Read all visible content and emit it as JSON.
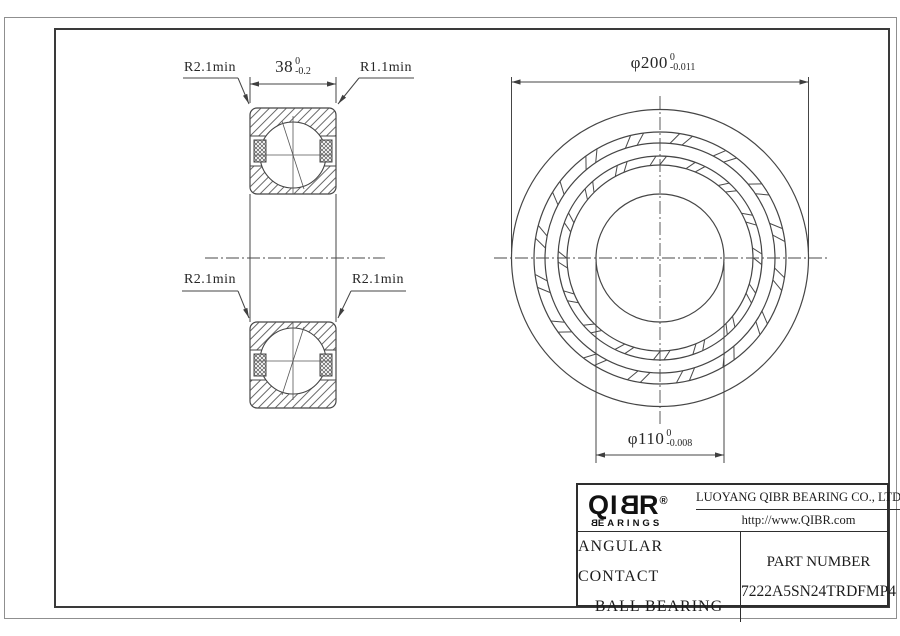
{
  "drawing": {
    "labels": {
      "radius_top_left": "R2.1min",
      "radius_top_right": "R1.1min",
      "radius_mid_left": "R2.1min",
      "radius_mid_right": "R2.1min"
    },
    "dimensions": {
      "width": {
        "value": "38",
        "tol_upper": "0",
        "tol_lower": "-0.2"
      },
      "outer_diameter": {
        "value": "φ200",
        "tol_upper": "0",
        "tol_lower": "-0.011"
      },
      "bore_diameter": {
        "value": "φ110",
        "tol_upper": "0",
        "tol_lower": "-0.008"
      }
    }
  },
  "title_block": {
    "logo": {
      "text_start": "QI",
      "text_b": "B",
      "text_end": "R",
      "reg": "®",
      "sub_start": "B",
      "sub_end": "EARINGS"
    },
    "company": "LUOYANG QIBR BEARING CO., LTD",
    "website": "http://www.QIBR.com",
    "product_line1": "ANGULAR CONTACT",
    "product_line2": "BALL BEARING",
    "part_label": "PART NUMBER",
    "part_number": "7222A5SN24TRDFMP4"
  },
  "colors": {
    "line": "#454545",
    "text": "#262626",
    "frame": "#3a3a3a"
  }
}
